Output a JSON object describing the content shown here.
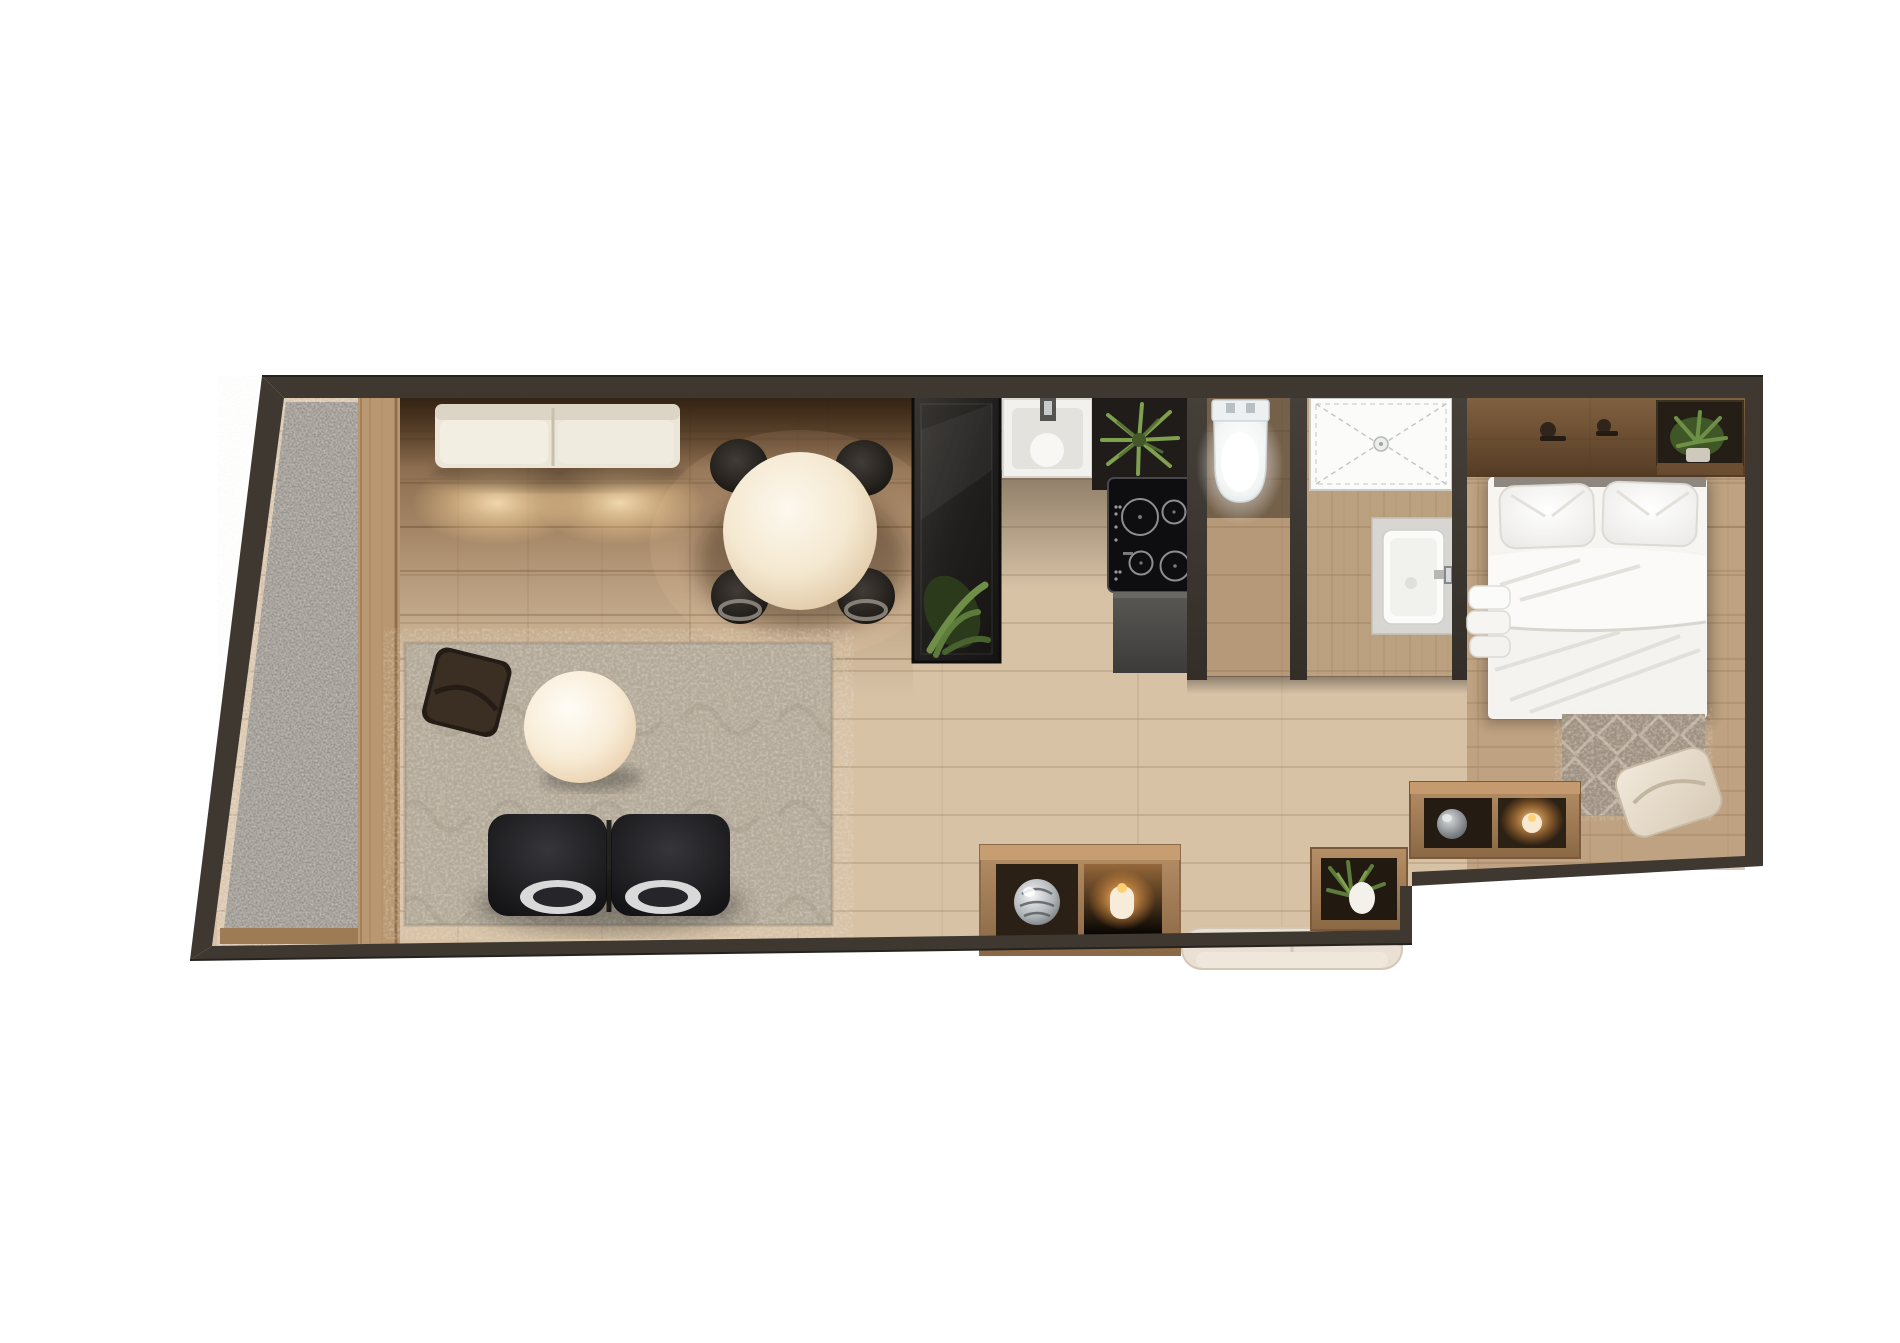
{
  "meta": {
    "title": "studio-apartment-floor-plan-top-view",
    "canvas": {
      "width": 1900,
      "height": 1343
    },
    "visible_text": "none"
  },
  "palette": {
    "background": "#ffffff",
    "wall": "#3e3831",
    "wall_dark": "#2c2823",
    "floor_pale": "#d7c2a6",
    "floor_plank_line": "#b49879",
    "floor_living_dark": "#6e4e31",
    "concrete": "#a09a92",
    "door_frame_wood": "#b99а77",
    "rug_living": "#b3a998",
    "rug_bedroom": "#9f9181",
    "sofa_cream": "#ece6d9",
    "loveseat_black": "#17171a",
    "table_white": "#f9f2e4",
    "chair_dark": "#2e2a26",
    "cabinet_black": "#24211f",
    "counter_gray": "#4b4a47",
    "fixture_white": "#f5f5f3",
    "candle_glow": "#ffb763",
    "plant_green": "#5d7b3a",
    "bedding_white": "#f6f5f2",
    "bench_cream": "#e9e0d3",
    "console_wood": "#a8835d",
    "chrome": "#c7c9cb"
  },
  "rooms": [
    {
      "name": "balcony",
      "items": [
        "concrete-floor",
        "sliding-door-frame",
        "window-sill"
      ]
    },
    {
      "name": "living-room",
      "items": [
        "cream-sofa",
        "floor-light-pools",
        "round-dining-table",
        "dining-chair",
        "dining-chair",
        "dining-chair",
        "dining-chair",
        "area-rug",
        "dark-floor-pillow",
        "round-coffee-table",
        "black-loveseat",
        "chrome-stool",
        "chrome-stool",
        "black-wardrobe",
        "wardrobe-plant"
      ]
    },
    {
      "name": "kitchen",
      "items": [
        "kitchen-sink",
        "faucet",
        "shelf-plant",
        "induction-cooktop",
        "base-counter"
      ]
    },
    {
      "name": "wc",
      "items": [
        "toilet"
      ]
    },
    {
      "name": "shower-room",
      "items": [
        "shower-tray",
        "drain",
        "washbasin",
        "basin-faucet"
      ]
    },
    {
      "name": "bedroom",
      "items": [
        "headboard-shelf",
        "wall-hook",
        "wall-hook",
        "niche-plant",
        "double-bed",
        "pillow",
        "pillow",
        "duvet",
        "towel-stack",
        "bedside-console",
        "decor-vase",
        "lit-candle",
        "bedroom-rug",
        "accent-pillow"
      ]
    },
    {
      "name": "hallway",
      "items": [
        "storage-console",
        "glass-ball-vase",
        "lit-candle",
        "upholstered-bench",
        "planter-box",
        "planter-plant"
      ]
    }
  ],
  "counts": {
    "cooktop_burners": 4,
    "dining_chairs": 4,
    "bed_pillows": 2,
    "lit_candles": 2,
    "plants": 4
  }
}
